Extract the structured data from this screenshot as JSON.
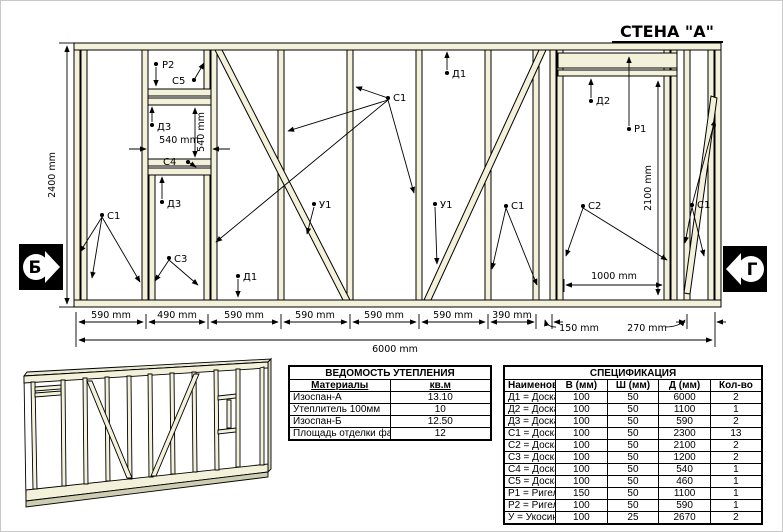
{
  "drawing": {
    "title": "СТЕНА \"А\"",
    "wall_height": "2400 mm",
    "wall_length": "6000 mm",
    "window_width": "540 mm",
    "window_height": "540 mm",
    "door_width": "1000 mm",
    "door_height": "2100 mm",
    "segments": [
      "590 mm",
      "490 mm",
      "590 mm",
      "590 mm",
      "590 mm",
      "590 mm",
      "390 mm",
      "150 mm",
      "270 mm"
    ],
    "marker_left": "Б",
    "marker_right": "Г",
    "labels": {
      "p2": "Р2",
      "c5": "С5",
      "d3_top": "Д3",
      "c4": "С4",
      "d3_mid": "Д3",
      "c3": "С3",
      "c1_left": "С1",
      "c1_mid": "С1",
      "c1_door": "С1",
      "c1_right": "С1",
      "u1_left": "У1",
      "u1_right": "У1",
      "d1_top": "Д1",
      "d1_bottom": "Д1",
      "d2": "Д2",
      "p1": "Р1",
      "c2": "С2"
    }
  },
  "insulation_table": {
    "title": "ВЕДОМОСТЬ УТЕПЛЕНИЯ",
    "headers": [
      "Материалы",
      "кв.м"
    ],
    "rows": [
      [
        "Изоспан-А",
        "13.10"
      ],
      [
        "Утеплитель 100мм",
        "10"
      ],
      [
        "Изоспан-Б",
        "12.50"
      ],
      [
        "Площадь отделки фасада",
        "12"
      ]
    ]
  },
  "spec_table": {
    "title": "СПЕЦИФИКАЦИЯ",
    "headers": [
      "Наименование",
      "В (мм)",
      "Ш (мм)",
      "Д (мм)",
      "Кол-во"
    ],
    "rows": [
      [
        "Д1 = Доска хвоя А-Б",
        "100",
        "50",
        "6000",
        "2"
      ],
      [
        "Д2 = Доска хвоя А-Б",
        "100",
        "50",
        "1100",
        "1"
      ],
      [
        "Д3 = Доска хвоя А-Б",
        "100",
        "50",
        "590",
        "2"
      ],
      [
        "С1 = Доска хвоя А-Б",
        "100",
        "50",
        "2300",
        "13"
      ],
      [
        "С2 = Доска хвоя А-Б",
        "100",
        "50",
        "2100",
        "2"
      ],
      [
        "С3 = Доска хвоя А-Б",
        "100",
        "50",
        "1200",
        "2"
      ],
      [
        "С4 = Доска хвоя А-Б",
        "100",
        "50",
        "540",
        "1"
      ],
      [
        "С5 = Доска хвоя А-Б",
        "100",
        "50",
        "460",
        "1"
      ],
      [
        "Р1 = Ригель",
        "150",
        "50",
        "1100",
        "1"
      ],
      [
        "Р2 = Ригель",
        "100",
        "50",
        "590",
        "1"
      ],
      [
        "У = Укосина хвоя А-Б",
        "100",
        "25",
        "2670",
        "2"
      ]
    ]
  },
  "colors": {
    "board_fill": "#f3f1da",
    "line": "#000000"
  }
}
